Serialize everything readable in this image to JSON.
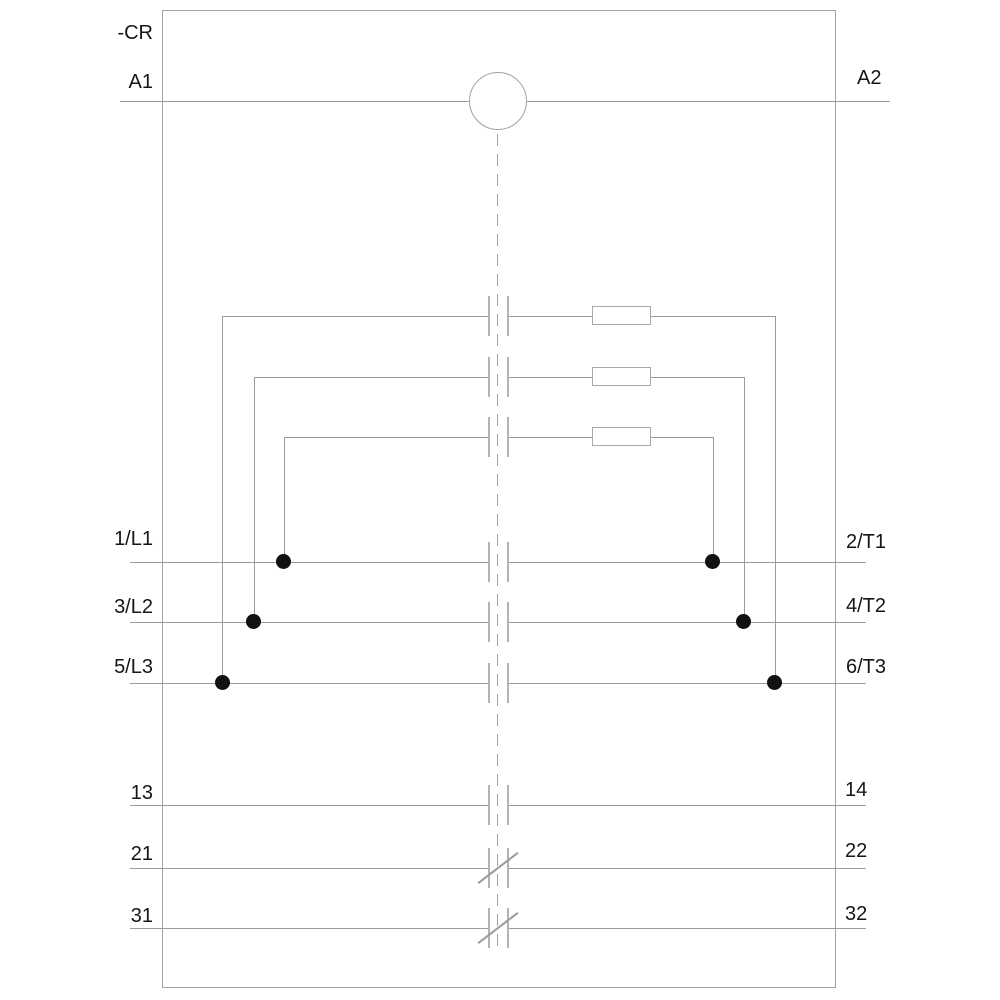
{
  "diagram": {
    "type": "contactor-schematic",
    "device_designation": "-CR",
    "coil": {
      "left_terminal": "A1",
      "right_terminal": "A2",
      "symbol": "circle"
    },
    "main_poles": [
      {
        "left_terminal": "1/L1",
        "right_terminal": "2/T1",
        "contact_type": "NO"
      },
      {
        "left_terminal": "3/L2",
        "right_terminal": "4/T2",
        "contact_type": "NO"
      },
      {
        "left_terminal": "5/L3",
        "right_terminal": "6/T3",
        "contact_type": "NO"
      }
    ],
    "precharge_contacts": [
      {
        "contact_type": "NO",
        "element": "resistor",
        "parallel_to_pole": "5/L3-6/T3"
      },
      {
        "contact_type": "NO",
        "element": "resistor",
        "parallel_to_pole": "3/L2-4/T2"
      },
      {
        "contact_type": "NO",
        "element": "resistor",
        "parallel_to_pole": "1/L1-2/T1"
      }
    ],
    "aux_contacts": [
      {
        "left_terminal": "13",
        "right_terminal": "14",
        "contact_type": "NO"
      },
      {
        "left_terminal": "21",
        "right_terminal": "22",
        "contact_type": "NC"
      },
      {
        "left_terminal": "31",
        "right_terminal": "32",
        "contact_type": "NC"
      }
    ],
    "colors": {
      "wire": "#9b9b9b",
      "frame": "#a2a2a2",
      "text": "#161616",
      "junction_dot": "#111111",
      "background": "#ffffff"
    }
  },
  "labels": {
    "device": "-CR",
    "a1": "A1",
    "a2": "A2",
    "l1": "1/L1",
    "l2": "3/L2",
    "l3": "5/L3",
    "t1": "2/T1",
    "t2": "4/T2",
    "t3": "6/T3",
    "no13": "13",
    "no14": "14",
    "nc21": "21",
    "nc22": "22",
    "nc31": "31",
    "nc32": "32"
  }
}
